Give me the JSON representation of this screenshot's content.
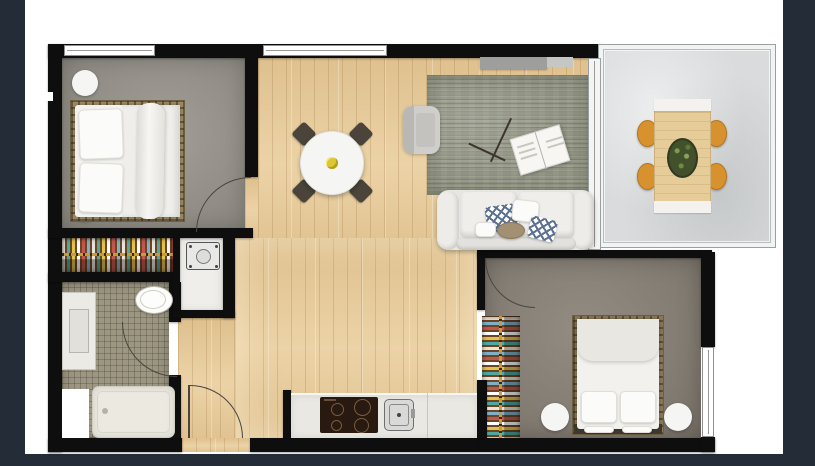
{
  "meta": {
    "kind": "apartment-floor-plan",
    "view": "top-down-3d-render"
  },
  "canvas": {
    "width": 815,
    "height": 466
  },
  "colors": {
    "bg": "#232c37",
    "page": "#ffffff",
    "wall": "#0e0e0f",
    "door_line": "#4a463f",
    "window_frame": "#8f8f8f",
    "wood": "#e8cd9e",
    "carpet1": "#97938b",
    "carpet2": "#8a8278",
    "rug": "#8e9180",
    "tile": "#9c9682",
    "balcony_floor": "#d9dbdc",
    "laundry_floor": "#efeeea",
    "wardrobe_wood": "#6e4522",
    "rail_gold": "#c79a3a",
    "washer": "#e8e8e6",
    "counter": "#eae8e3",
    "cooktop": "#281911",
    "sofa": "#e7e6e2",
    "pillow_blue": "#5d7191",
    "bed_frame": "#9b8a66",
    "white_furniture": "#f5f5f3",
    "chair_dark": "#4a443a",
    "outdoor_chair": "#d8912f",
    "outdoor_table": "#e6cc99",
    "plant": "#42502c",
    "flower": "#ddc832",
    "console_gray": "#9e9e9c"
  },
  "rooms": [
    {
      "name": "bedroom-1",
      "furniture": [
        "double-bed",
        "side-table",
        "side-table",
        "wardrobe-hanging-rail"
      ]
    },
    {
      "name": "bathroom",
      "furniture": [
        "vanity-sink",
        "toilet",
        "bathtub"
      ]
    },
    {
      "name": "laundry-closet",
      "furniture": [
        "washing-machine"
      ]
    },
    {
      "name": "entry-hall",
      "furniture": [
        "entry-door"
      ]
    },
    {
      "name": "kitchen",
      "furniture": [
        "counter",
        "cooktop",
        "sink"
      ]
    },
    {
      "name": "dining-area",
      "furniture": [
        "round-table",
        "chair",
        "chair",
        "chair",
        "chair",
        "flower-centerpiece"
      ]
    },
    {
      "name": "living-area",
      "furniture": [
        "sofa",
        "throw-pillows",
        "pouf",
        "armchair",
        "rug",
        "floor-lamp",
        "magazine",
        "tv-console",
        "sliding-door"
      ]
    },
    {
      "name": "bedroom-2",
      "furniture": [
        "double-bed",
        "side-table",
        "side-table",
        "wardrobe-hanging-rail"
      ]
    },
    {
      "name": "balcony",
      "furniture": [
        "outdoor-table",
        "outdoor-chair",
        "outdoor-chair",
        "outdoor-chair",
        "outdoor-chair",
        "plant-centerpiece"
      ]
    }
  ]
}
